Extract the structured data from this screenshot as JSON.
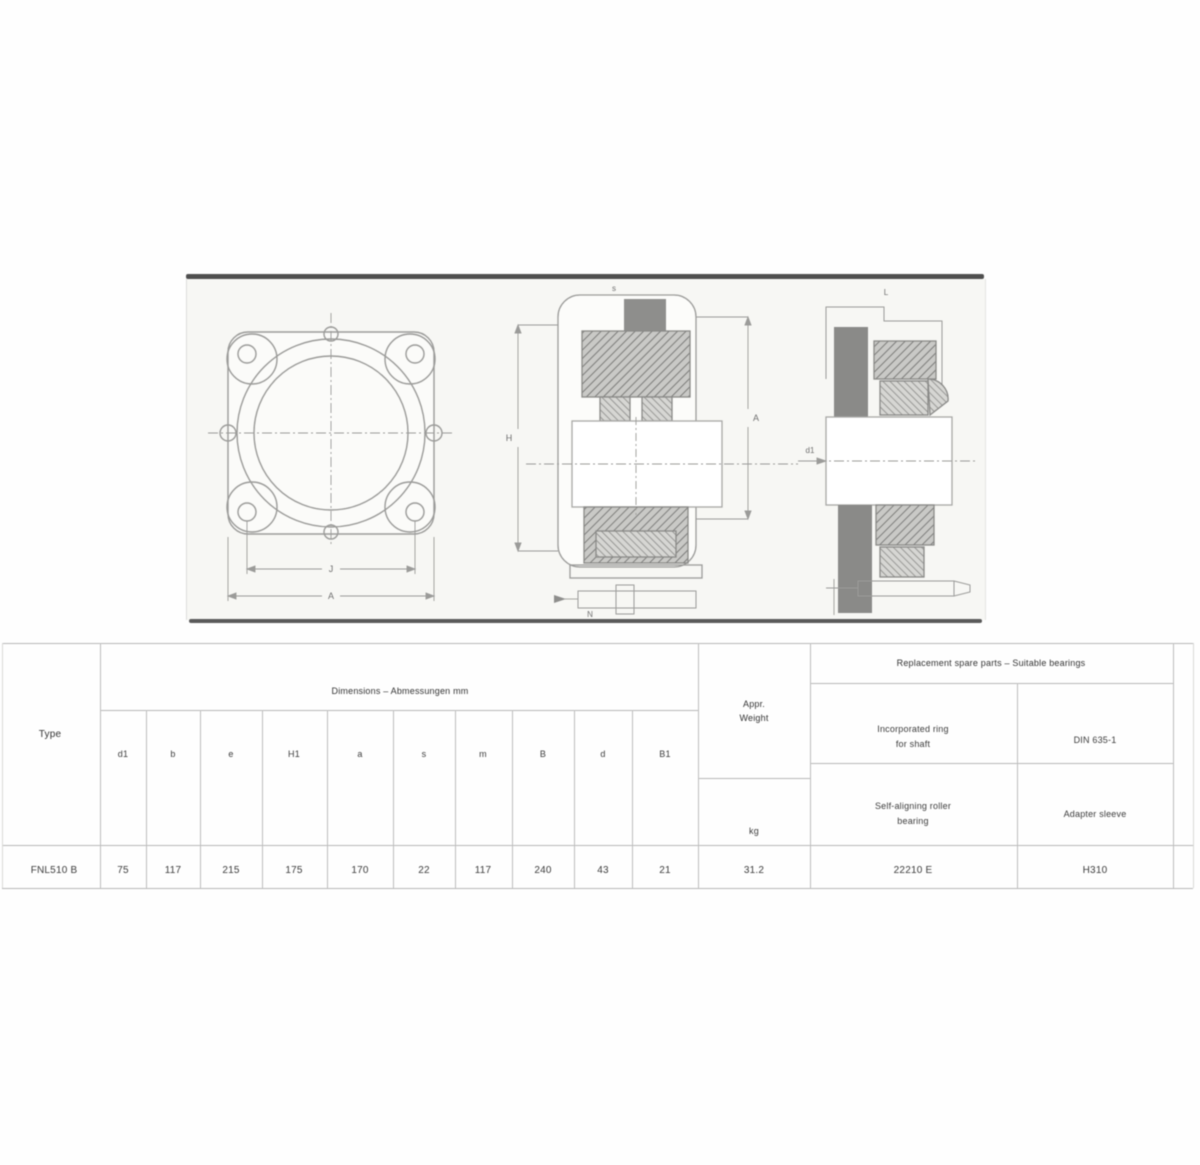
{
  "table": {
    "type_header": "Type",
    "dim_group_header": "Dimensions – Abmessungen  mm",
    "dim_columns": [
      "d1",
      "b",
      "e",
      "H1",
      "a",
      "s",
      "m",
      "B",
      "d",
      "B1"
    ],
    "weight_header_line1": "Appr.",
    "weight_header_line2": "Weight",
    "weight_unit": "kg",
    "spare_header": "Replacement spare parts – Suitable bearings",
    "spare_row1_left_line1": "Incorporated ring",
    "spare_row1_left_line2": "for shaft",
    "spare_row1_right": "DIN 635-1",
    "spare_row2_left_line1": "Self-aligning roller",
    "spare_row2_left_line2": "bearing",
    "spare_row2_right": "Adapter sleeve",
    "row": {
      "type": "FNL510 B",
      "values": [
        "75",
        "117",
        "215",
        "175",
        "170",
        "22",
        "117",
        "240",
        "43",
        "21"
      ],
      "weight": "31.2",
      "bearing": "22210 E",
      "sleeve": "H310"
    }
  },
  "drawing": {
    "labels": {
      "front_bolt_span": "J",
      "front_total": "A",
      "side_height": "H",
      "side_width": "A",
      "side_screw": "s",
      "side_bottom": "N",
      "right_top": "L",
      "right_bore": "d1"
    }
  }
}
